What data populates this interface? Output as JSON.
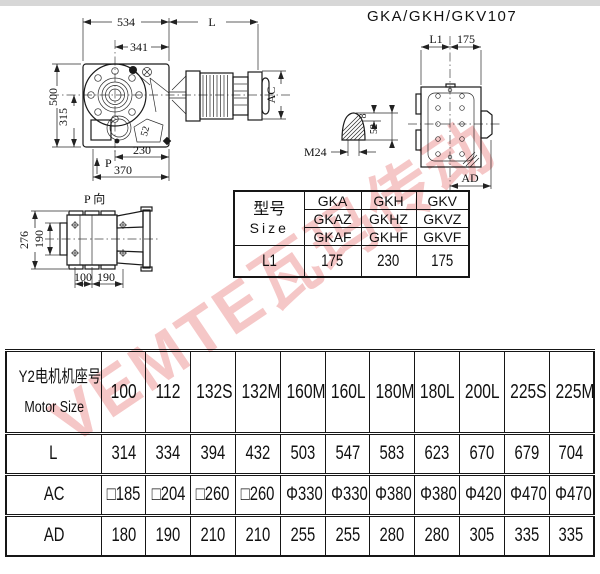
{
  "title": "GKA/GKH/GKV107",
  "watermark": {
    "text": "VEMTE瓦玛传动"
  },
  "front_view": {
    "d534": "534",
    "dL": "L",
    "d341": "341",
    "d500": "500",
    "d315": "315",
    "d52": "52",
    "d230": "230",
    "dP": "P",
    "d370": "370",
    "dAC": "AC"
  },
  "side_view": {
    "dL1": "L1",
    "d175": "175",
    "dAD": "AD"
  },
  "shaft_detail": {
    "d8": "8",
    "d52": "52",
    "thread": "M24"
  },
  "p_view": {
    "label": "P 向",
    "d276": "276",
    "d190v": "190",
    "d100": "100",
    "d190h": "190"
  },
  "size_table": {
    "header_cn": "型号",
    "header_en": "Size",
    "model_rows": [
      [
        "GKA",
        "GKH",
        "GKV"
      ],
      [
        "GKAZ",
        "GKHZ",
        "GKVZ"
      ],
      [
        "GKAF",
        "GKHF",
        "GKVF"
      ]
    ],
    "l1_label": "L1",
    "l1_values": [
      "175",
      "230",
      "175"
    ]
  },
  "motor_table": {
    "header_cn": "Y2电机机座号",
    "header_en": "Motor Size",
    "columns": [
      "100",
      "112",
      "132S",
      "132M",
      "160M",
      "160L",
      "180M",
      "180L",
      "200L",
      "225S",
      "225M"
    ],
    "rows": [
      {
        "label": "L",
        "values": [
          "314",
          "334",
          "394",
          "432",
          "503",
          "547",
          "583",
          "623",
          "670",
          "679",
          "704"
        ]
      },
      {
        "label": "AC",
        "values": [
          "□185",
          "□204",
          "□260",
          "□260",
          "Φ330",
          "Φ330",
          "Φ380",
          "Φ380",
          "Φ420",
          "Φ470",
          "Φ470"
        ]
      },
      {
        "label": "AD",
        "values": [
          "180",
          "190",
          "210",
          "210",
          "255",
          "255",
          "280",
          "280",
          "305",
          "335",
          "335"
        ]
      }
    ]
  }
}
